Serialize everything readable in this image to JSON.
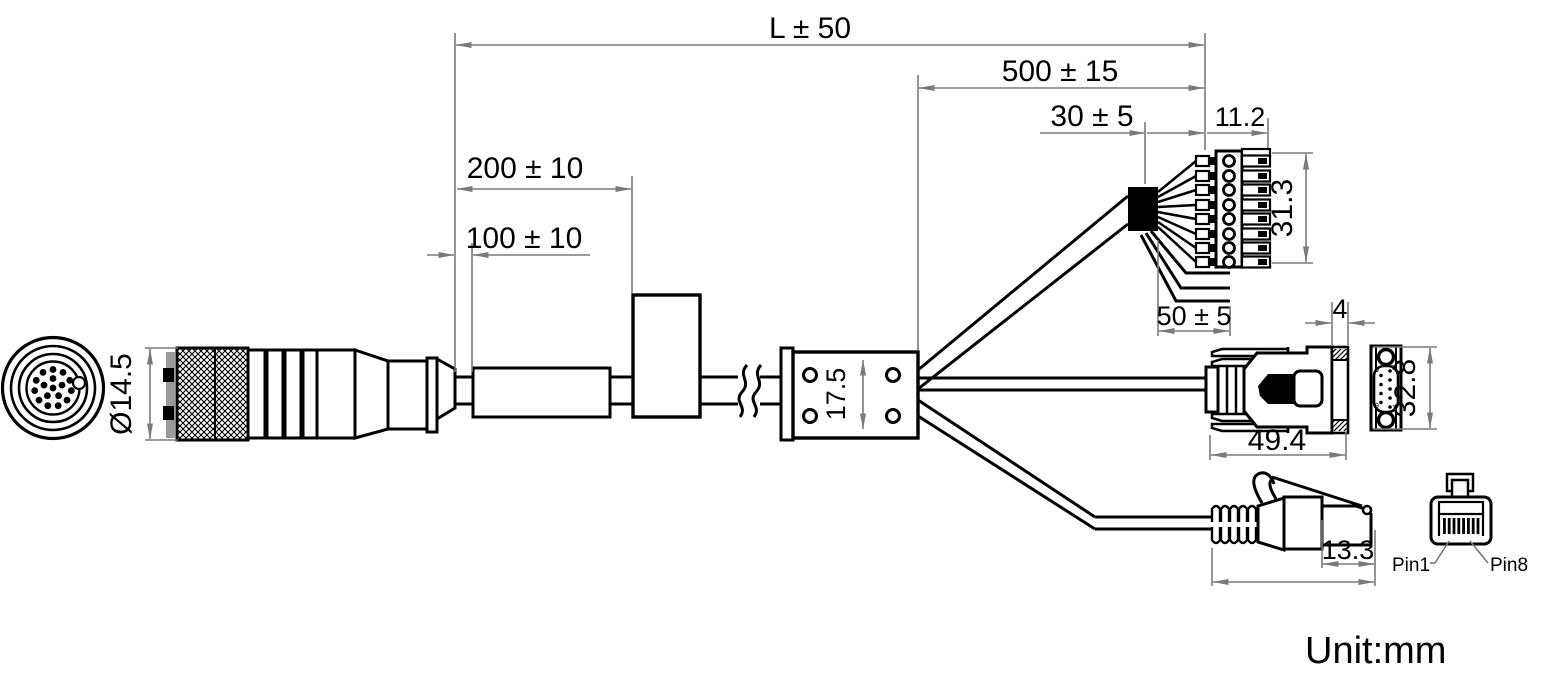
{
  "title": {
    "unit_label": "Unit:mm"
  },
  "colors": {
    "line": "#000000",
    "dimension": "#7a7a7a",
    "background": "#ffffff"
  },
  "dimensions": {
    "overall_length": "L ± 50",
    "branch_length": "500 ± 15",
    "exposed_wires": "30 ± 5",
    "tube_distance_200": "200 ± 10",
    "tube_distance_100": "100 ± 10",
    "terminal_depth": "11.2",
    "terminal_height": "31.3",
    "spare_wire_length": "50 ± 5",
    "junction_height": "17.5",
    "connector_diameter": "Ø14.5",
    "db9_flange_thickness": "4",
    "db9_length": "49.4",
    "db9_height": "32.8",
    "rj45_plug_length": "13.3"
  },
  "rj45_front": {
    "pin1_label": "Pin1",
    "pin8_label": "Pin8"
  },
  "db9_front_pins": {
    "top_left": "6",
    "top_right": "5",
    "bottom_left": "9",
    "bottom_right": "1"
  }
}
